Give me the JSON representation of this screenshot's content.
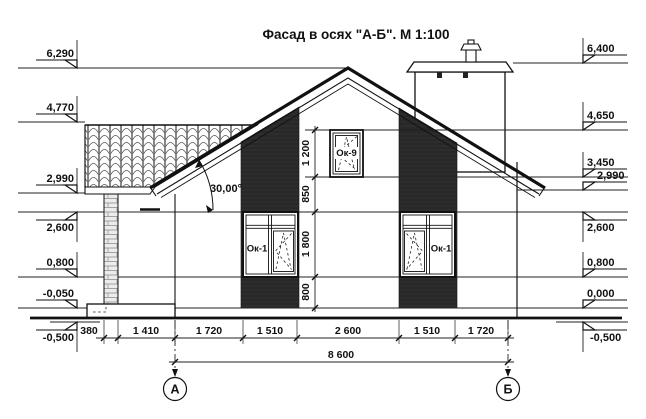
{
  "title": "Фасад в осях \"А-Б\". М 1:100",
  "angle_label": "30,00°",
  "levels_left": [
    "6,290",
    "4,770",
    "2,990",
    "2,600",
    "0,800",
    "-0,050",
    "-0,500"
  ],
  "levels_right": [
    "6,400",
    "4,650",
    "3,450",
    "2,990",
    "2,600",
    "0,800",
    "0,000",
    "-0,500"
  ],
  "dims_bottom": [
    "380",
    "1 410",
    "1 720",
    "1 510",
    "2 600",
    "1 510",
    "1 720"
  ],
  "dim_total": "8 600",
  "dims_vertical": [
    "1 200",
    "850",
    "1 800",
    "800"
  ],
  "windows": {
    "small": "Ок-9",
    "left": "Ок-1",
    "right": "Ок-1"
  },
  "axes": {
    "a": "А",
    "b": "Б"
  },
  "colors": {
    "line": "#111111",
    "strip": "#282828",
    "background": "#ffffff"
  }
}
